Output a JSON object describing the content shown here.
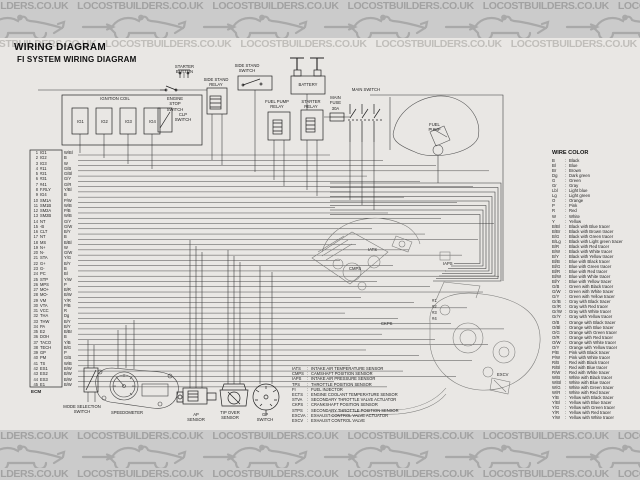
{
  "watermark": {
    "text": "LOCOSTBUILDERS.CO.UK"
  },
  "titles": {
    "main": "WIRING DIAGRAM",
    "sub": "FI SYSTEM WIRING DIAGRAM"
  },
  "separator": ":",
  "ecm": {
    "label": "ECM",
    "pins": [
      {
        "no": "1",
        "name": "IG1",
        "wire": "W/Bl"
      },
      {
        "no": "2",
        "name": "IG2",
        "wire": "B"
      },
      {
        "no": "3",
        "name": "IG3",
        "wire": "W"
      },
      {
        "no": "4",
        "name": "#11",
        "wire": "G/B"
      },
      {
        "no": "5",
        "name": "#21",
        "wire": "G/Bl"
      },
      {
        "no": "6",
        "name": "#31",
        "wire": "G/Y"
      },
      {
        "no": "7",
        "name": "#41",
        "wire": "G/R"
      },
      {
        "no": "8",
        "name": "F.RLY",
        "wire": "Y/Bl"
      },
      {
        "no": "9",
        "name": "IG4",
        "wire": "B"
      },
      {
        "no": "10",
        "name": "SM1A",
        "wire": "P/W"
      },
      {
        "no": "11",
        "name": "SM1B",
        "wire": "W/B"
      },
      {
        "no": "12",
        "name": "SM2A",
        "wire": "P/B"
      },
      {
        "no": "13",
        "name": "SM2B",
        "wire": "W/B"
      },
      {
        "no": "14",
        "name": "NT",
        "wire": "G/Y"
      },
      {
        "no": "15",
        "name": "-B",
        "wire": "G/W"
      },
      {
        "no": "16",
        "name": "CLT",
        "wire": "B/Y"
      },
      {
        "no": "17",
        "name": "NT",
        "wire": "B"
      },
      {
        "no": "18",
        "name": "MS",
        "wire": "B/Bl"
      },
      {
        "no": "19",
        "name": "N+",
        "wire": "W"
      },
      {
        "no": "20",
        "name": "N-",
        "wire": "G/W"
      },
      {
        "no": "21",
        "name": "STA",
        "wire": "Y/G"
      },
      {
        "no": "22",
        "name": "G+",
        "wire": "B/Y"
      },
      {
        "no": "23",
        "name": "G-",
        "wire": "B"
      },
      {
        "no": "24",
        "name": "PC",
        "wire": "Bl"
      },
      {
        "no": "25",
        "name": "STP",
        "wire": "Y/W"
      },
      {
        "no": "26",
        "name": "MPS",
        "wire": "P"
      },
      {
        "no": "27",
        "name": "MO+",
        "wire": "B/R"
      },
      {
        "no": "28",
        "name": "MO-",
        "wire": "B/W"
      },
      {
        "no": "29",
        "name": "VM",
        "wire": "Y/R"
      },
      {
        "no": "30",
        "name": "VTA",
        "wire": "P/B"
      },
      {
        "no": "31",
        "name": "VCC",
        "wire": "R"
      },
      {
        "no": "32",
        "name": "THA",
        "wire": "Dg"
      },
      {
        "no": "33",
        "name": "THW",
        "wire": "B/Y"
      },
      {
        "no": "34",
        "name": "PA",
        "wire": "B/Y"
      },
      {
        "no": "35",
        "name": "E2",
        "wire": "B/Br"
      },
      {
        "no": "36",
        "name": "DOH",
        "wire": "B"
      },
      {
        "no": "37",
        "name": "TACO",
        "wire": "Y/B"
      },
      {
        "no": "38",
        "name": "TECH",
        "wire": "B/G"
      },
      {
        "no": "39",
        "name": "GP",
        "wire": "P"
      },
      {
        "no": "40",
        "name": "PM",
        "wire": "G/B"
      },
      {
        "no": "41",
        "name": "TS",
        "wire": "W/B"
      },
      {
        "no": "42",
        "name": "ES1",
        "wire": "B/W"
      },
      {
        "no": "43",
        "name": "ES2",
        "wire": "B/W"
      },
      {
        "no": "44",
        "name": "ES3",
        "wire": "B/W"
      },
      {
        "no": "45",
        "name": "E1",
        "wire": "B/W"
      }
    ]
  },
  "components": {
    "ignition_coil": "IGNITION COIL",
    "coils": [
      "IG1",
      "IG2",
      "IG3",
      "IG4"
    ],
    "clp_switch": "CLP SWITCH",
    "engine_stop_switch": "ENGINE STOP SWITCH",
    "starter_button": "STARTER BUTTON",
    "side_stand_relay": "SIDE STAND RELAY",
    "side_stand_switch": "SIDE STAND SWITCH",
    "battery": "BATTERY",
    "fuel_pump_relay": "FUEL PUMP RELAY",
    "starter_relay": "STARTER RELAY",
    "main_fuse": "MAIN FUSE 30A",
    "main_switch": "MAIN SWITCH",
    "fuel_pump": "FUEL PUMP",
    "mode_selection_switch": "MODE SELECTION SWITCH",
    "speedometer": "SPEEDOMETER",
    "ap_sensor": "AP SENSOR",
    "tip_over_sensor": "TIP OVER SENSOR",
    "gp_switch": "GP SWITCH",
    "engine_labels": [
      "IATS",
      "CMPS",
      "IAPS",
      "CKPS",
      "EXCV"
    ],
    "injector_tags": [
      "#1",
      "#2",
      "#3",
      "#4"
    ]
  },
  "wire_color_legend": {
    "title": "WIRE COLOR",
    "entries": [
      {
        "code": "B",
        "name": "Black"
      },
      {
        "code": "Bl",
        "name": "Blue"
      },
      {
        "code": "Br",
        "name": "Brown"
      },
      {
        "code": "Dg",
        "name": "Dark green"
      },
      {
        "code": "G",
        "name": "Green"
      },
      {
        "code": "Gr",
        "name": "Gray"
      },
      {
        "code": "Lbl",
        "name": "Light blue"
      },
      {
        "code": "Lg",
        "name": "Light green"
      },
      {
        "code": "O",
        "name": "Orange"
      },
      {
        "code": "P",
        "name": "Pink"
      },
      {
        "code": "R",
        "name": "Red"
      },
      {
        "code": "W",
        "name": "White"
      },
      {
        "code": "Y",
        "name": "Yellow"
      },
      {
        "code": "B/Bl",
        "name": "Black with Blue tracer"
      },
      {
        "code": "B/Br",
        "name": "Black with Brown tracer"
      },
      {
        "code": "B/G",
        "name": "Black with Green tracer"
      },
      {
        "code": "B/Lg",
        "name": "Black with Light green tracer"
      },
      {
        "code": "B/R",
        "name": "Black with Red tracer"
      },
      {
        "code": "B/W",
        "name": "Black with White tracer"
      },
      {
        "code": "B/Y",
        "name": "Black with Yellow tracer"
      },
      {
        "code": "Bl/B",
        "name": "Blue with Black tracer"
      },
      {
        "code": "Bl/G",
        "name": "Blue with Green tracer"
      },
      {
        "code": "Bl/R",
        "name": "Blue with Red tracer"
      },
      {
        "code": "Bl/W",
        "name": "Blue with White tracer"
      },
      {
        "code": "Bl/Y",
        "name": "Blue with Yellow tracer"
      },
      {
        "code": "G/B",
        "name": "Green with Black tracer"
      },
      {
        "code": "G/W",
        "name": "Green with White tracer"
      },
      {
        "code": "G/Y",
        "name": "Green with Yellow tracer"
      },
      {
        "code": "Gr/B",
        "name": "Gray with Black tracer"
      },
      {
        "code": "Gr/R",
        "name": "Gray with Red tracer"
      },
      {
        "code": "Gr/W",
        "name": "Gray with White tracer"
      },
      {
        "code": "Gr/Y",
        "name": "Gray with Yellow tracer"
      },
      {
        "code": "O/B",
        "name": "Orange with Black tracer"
      },
      {
        "code": "O/Bl",
        "name": "Orange with Blue tracer"
      },
      {
        "code": "O/G",
        "name": "Orange with Green tracer"
      },
      {
        "code": "O/R",
        "name": "Orange with Red tracer"
      },
      {
        "code": "O/W",
        "name": "Orange with White tracer"
      },
      {
        "code": "O/Y",
        "name": "Orange with Yellow tracer"
      },
      {
        "code": "P/B",
        "name": "Pink with Black tracer"
      },
      {
        "code": "P/W",
        "name": "Pink with White tracer"
      },
      {
        "code": "R/B",
        "name": "Red with Black tracer"
      },
      {
        "code": "R/Bl",
        "name": "Red with Blue tracer"
      },
      {
        "code": "R/W",
        "name": "Red with White tracer"
      },
      {
        "code": "W/B",
        "name": "White with Black tracer"
      },
      {
        "code": "W/Bl",
        "name": "White with Blue tracer"
      },
      {
        "code": "W/G",
        "name": "White with Green tracer"
      },
      {
        "code": "W/R",
        "name": "White with Red tracer"
      },
      {
        "code": "Y/B",
        "name": "Yellow with Black tracer"
      },
      {
        "code": "Y/Bl",
        "name": "Yellow with Blue tracer"
      },
      {
        "code": "Y/G",
        "name": "Yellow with Green tracer"
      },
      {
        "code": "Y/R",
        "name": "Yellow with Red tracer"
      },
      {
        "code": "Y/W",
        "name": "Yellow with White tracer"
      }
    ]
  },
  "abbreviations": [
    {
      "code": "IATS",
      "name": "INTAKE AIR TEMPERATURE SENSOR"
    },
    {
      "code": "CMPS",
      "name": "CAMSHAFT POSITION SENSOR"
    },
    {
      "code": "IAPS",
      "name": "INTAKE AIR PRESSURE SENSOR"
    },
    {
      "code": "TPS",
      "name": "THROTTLE POSITION SENSOR"
    },
    {
      "code": "FI",
      "name": "FUEL INJECTOR"
    },
    {
      "code": "ECTS",
      "name": "ENGINE COOLANT TEMPERATURE SENSOR"
    },
    {
      "code": "STVA",
      "name": "SECONDARY THROTTLE VALVE ACTUATOR"
    },
    {
      "code": "CKPS",
      "name": "CRANKSHAFT POSITION SENSOR"
    },
    {
      "code": "STPS",
      "name": "SECONDARY THROTTLE POSITION SENSOR"
    },
    {
      "code": "EXCVA",
      "name": "EXHAUST CONTROL VALVE ACTUATOR"
    },
    {
      "code": "EXCV",
      "name": "EXHAUST CONTROL VALVE"
    }
  ],
  "colors": {
    "band_bg": "#cbcbcb",
    "watermark_text": "#a2a2a2",
    "paper": "#e9e7e4",
    "wire_line": "#333333"
  }
}
